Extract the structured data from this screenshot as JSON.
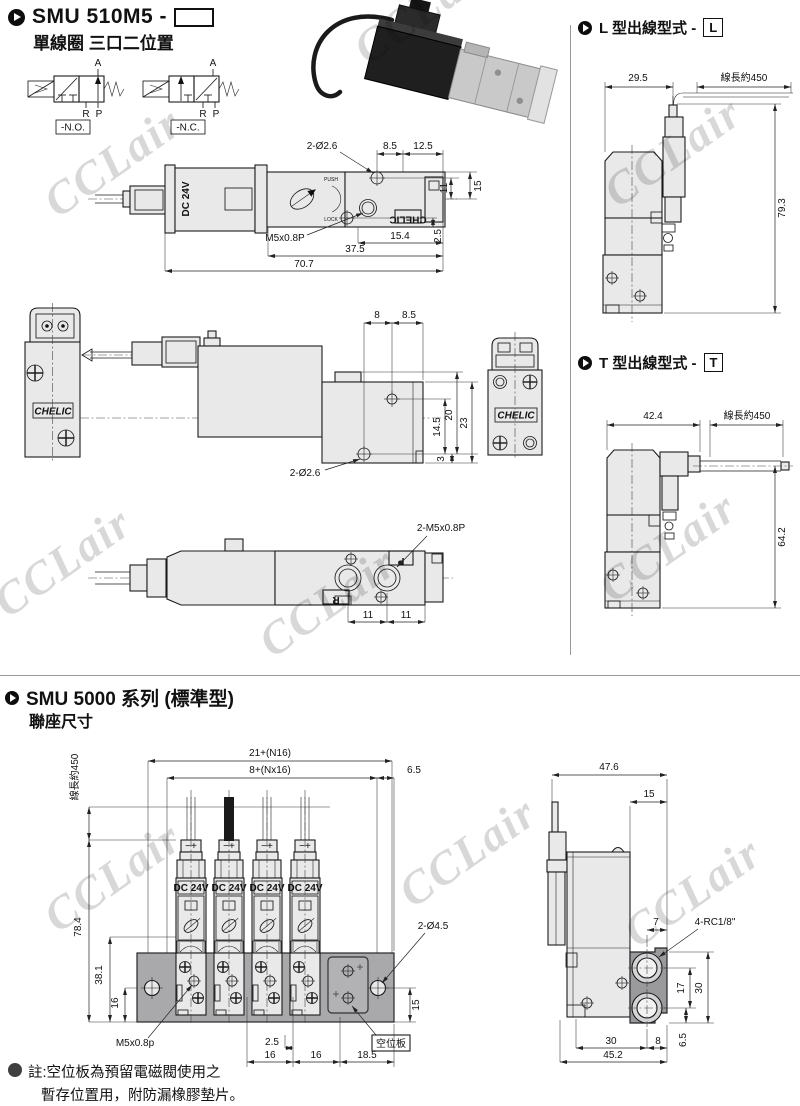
{
  "header": {
    "model": "SMU 510M5 -",
    "subtitle": "單線圈 三口二位置"
  },
  "symbols": {
    "a1": "A",
    "r1": "R",
    "p1": "P",
    "no": "-N.O.",
    "a2": "A",
    "r2": "R",
    "p2": "P",
    "nc": "-N.C."
  },
  "topview": {
    "coil": "DC 24V",
    "push": "PUSH",
    "lock": "LOCK",
    "brand_small": "CHELIC",
    "hole": "2-Ø2.6",
    "d1": "8.5",
    "d2": "12.5",
    "d3": "11",
    "d4": "15",
    "thread": "M5x0.8P",
    "d5": "15.4",
    "d6": "2.5",
    "d7": "37.5",
    "d8": "70.7"
  },
  "frontview": {
    "brand": "CHELIC"
  },
  "sideview": {
    "d1": "8",
    "d2": "8.5",
    "d3": "14.5",
    "d4": "20",
    "d5": "23",
    "d6": "3",
    "hole": "2-Ø2.6"
  },
  "frontview2": {
    "brand": "CHELIC"
  },
  "bottomview": {
    "thread": "2-M5x0.8P",
    "d1": "11",
    "d2": "11",
    "pr": "R",
    "pp": "P"
  },
  "ltype": {
    "title": "L 型出線型式 -",
    "code": "L",
    "w": "29.5",
    "cable": "線長約450",
    "h": "79.3"
  },
  "ttype": {
    "title": "T 型出線型式 -",
    "code": "T",
    "w": "42.4",
    "cable": "線長約450",
    "h": "64.2"
  },
  "smu5000": {
    "title": "SMU 5000 系列 (標準型)",
    "subtitle": "聯座尺寸"
  },
  "manifold": {
    "cable": "線長約450",
    "coil": "DC 24V",
    "term": "−+",
    "dt1": "21+(N16)",
    "dt2": "8+(Nx16)",
    "dt3": "6.5",
    "dl1": "78.4",
    "dl2": "38.1",
    "dl3": "16",
    "thread": "M5x0.8p",
    "db0": "2.5",
    "db1": "16",
    "db2": "16",
    "db3": "18.5",
    "dr1": "15",
    "hole": "2-Ø4.5",
    "blank": "空位板"
  },
  "endview": {
    "d1": "47.6",
    "d2": "15",
    "d3": "7",
    "port": "4-RC1/8\"",
    "d4": "17",
    "d5": "30",
    "d6": "6.5",
    "d7": "30",
    "d8": "8",
    "d9": "45.2"
  },
  "note": {
    "l1": "註:空位板為預留電磁閥使用之",
    "l2": "暫存位置用，附防漏橡膠墊片。"
  },
  "watermark": "CCLair",
  "colors": {
    "body_fill": "#e9e9e9",
    "manifold_fill": "#a9a9ab",
    "line": "#1b1b1b",
    "watermark": "#cfcfcf"
  }
}
